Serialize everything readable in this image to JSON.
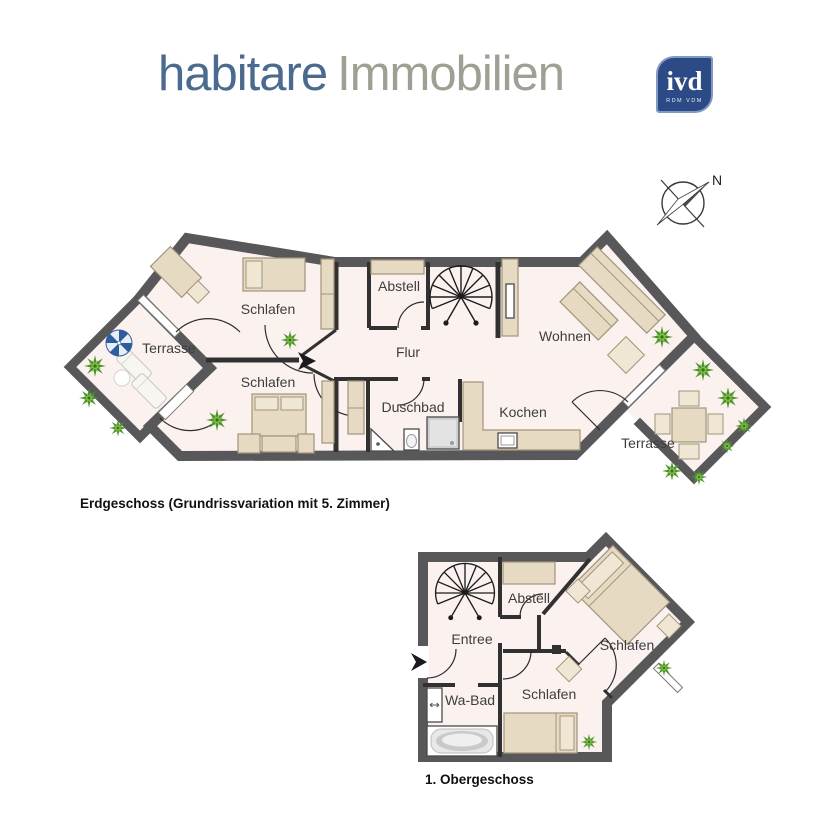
{
  "header": {
    "brand_primary": "habitare",
    "brand_secondary": "Immobilien",
    "ivd_label": "ivd",
    "ivd_sub": "RDM VDM"
  },
  "compass": {
    "north_label": "N"
  },
  "ground_floor": {
    "title": "Erdgeschoss (Grundrissvariation mit 5. Zimmer)",
    "rooms": {
      "schlafen_top": "Schlafen",
      "schlafen_bottom": "Schlafen",
      "terrasse_left": "Terrasse",
      "abstell": "Abstell",
      "flur": "Flur",
      "duschbad": "Duschbad",
      "kochen": "Kochen",
      "wohnen": "Wohnen",
      "terrasse_right": "Terrasse"
    }
  },
  "upper_floor": {
    "title": "1. Obergeschoss",
    "rooms": {
      "abstell": "Abstell",
      "entree": "Entree",
      "schlafen_right": "Schlafen",
      "schlafen_bottom": "Schlafen",
      "wabad": "Wa-Bad"
    }
  },
  "colors": {
    "brand_blue": "#4b6b8e",
    "brand_gray": "#a09f93",
    "ivd_background": "#2c4a86",
    "ivd_accent": "#8299c4",
    "wall": "#58585b",
    "floor": "#fbf2f0",
    "furniture": "#e6dbc2",
    "plant_green": "#5a9e32",
    "parasol_blue": "#2e5d9e"
  }
}
